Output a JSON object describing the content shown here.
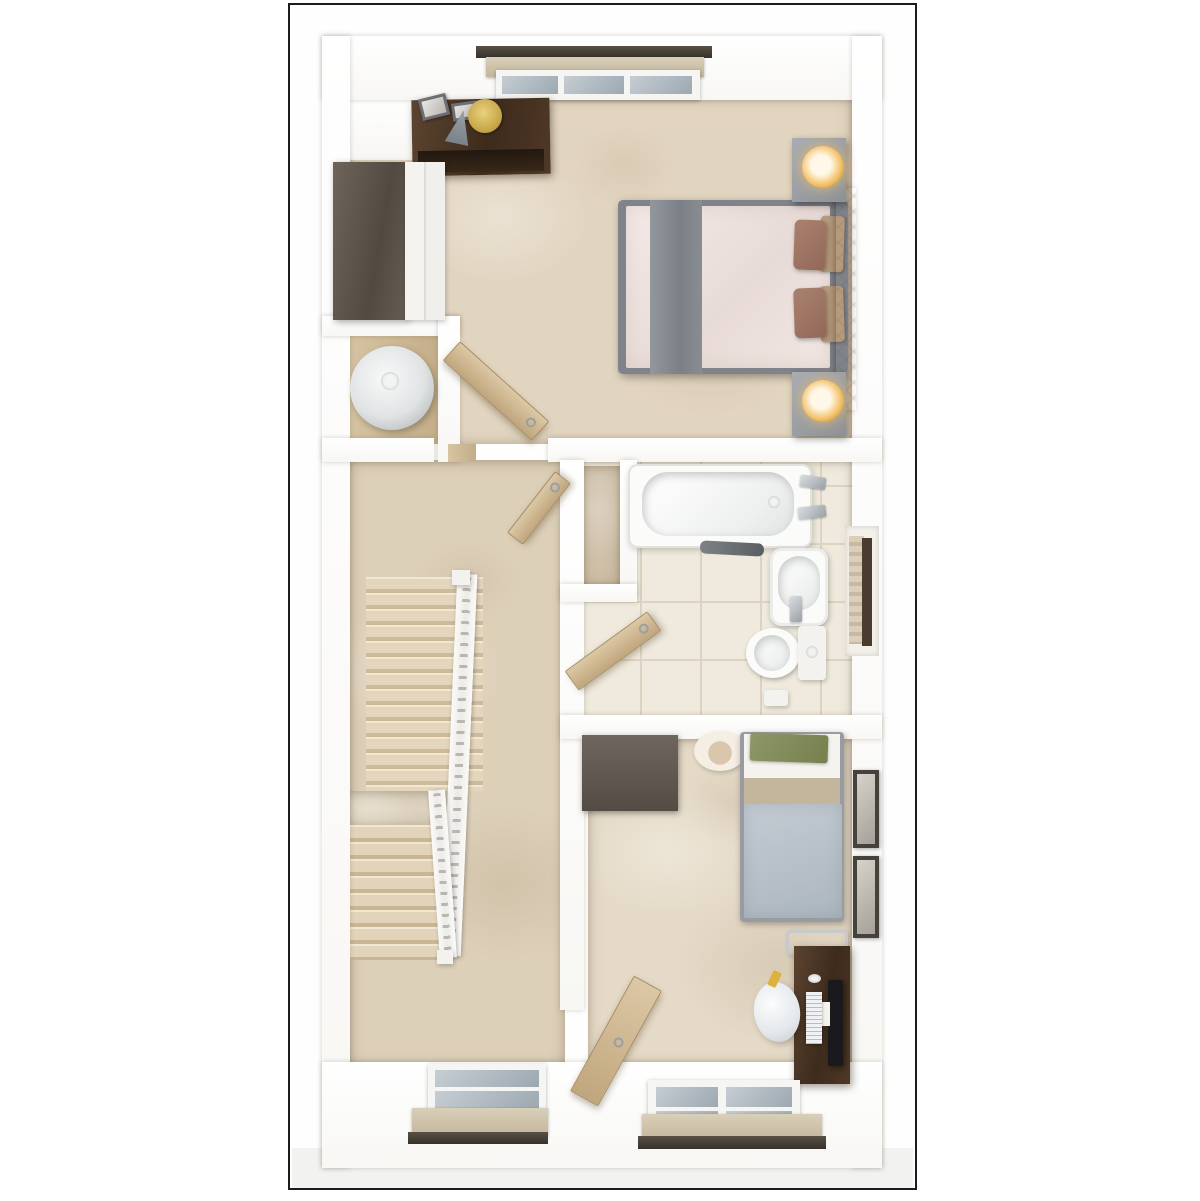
{
  "meta": {
    "kind": "3d-top-down-floor-plan-render",
    "floors_text": "",
    "labels_text": ""
  },
  "palette": {
    "frame_border": "#1c1c1c",
    "wall": "#ffffff",
    "carpet_master": "#e2d5c0",
    "carpet_landing": "#ddd0b9",
    "carpet_bedroom2": "#e5dac7",
    "carpet_niche": "#d5c6ae",
    "tile_bathroom": "#efeadd",
    "wood_door": "#cdb58c",
    "dark_wood": "#46331f",
    "grey_wood": "#5f564d",
    "bed_grey": "#7f838a",
    "duvet_pink": "#f0e4e1",
    "duvet_blue_grey": "#b8c2cc",
    "lamp_amber": "#f3c066",
    "green_pillow": "#8a9460"
  },
  "scene": {
    "elements": [
      {
        "name": "plan-frame",
        "cls": "frame",
        "x": 288,
        "y": 3,
        "w": 629,
        "h": 1187
      },
      {
        "name": "ground-shadow-strip",
        "cls": "ground",
        "x": 292,
        "y": 1148,
        "w": 621,
        "h": 40
      },
      {
        "name": "master-bedroom-floor",
        "cls": "carpet",
        "x": 347,
        "y": 96,
        "w": 505,
        "h": 348,
        "bgc": "#e2d5c0"
      },
      {
        "name": "airing-cupboard-floor",
        "cls": "woodfloor",
        "x": 344,
        "y": 332,
        "w": 100,
        "h": 112
      },
      {
        "name": "landing-floor",
        "cls": "carpet",
        "x": 350,
        "y": 460,
        "w": 215,
        "h": 605,
        "bgc": "#ddd0b9"
      },
      {
        "name": "bathroom-floor",
        "cls": "tile",
        "x": 582,
        "y": 460,
        "w": 270,
        "h": 257
      },
      {
        "name": "stair-niche-floor",
        "cls": "carpet",
        "x": 582,
        "y": 466,
        "w": 38,
        "h": 120,
        "bgc": "#d5c6ae"
      },
      {
        "name": "bedroom2-floor",
        "cls": "carpet",
        "x": 588,
        "y": 737,
        "w": 264,
        "h": 328,
        "bgc": "#e5dac7"
      },
      {
        "name": "wall-face-top-left",
        "cls": "wallface",
        "x": 347,
        "y": 96,
        "w": 78,
        "h": 64
      },
      {
        "name": "stairs-upper-flight",
        "cls": "flight",
        "x": 366,
        "y": 577,
        "w": 117,
        "h": 214
      },
      {
        "name": "stairs-mid-landing",
        "cls": "carpet",
        "x": 350,
        "y": 791,
        "w": 96,
        "h": 34,
        "bgc": "#e7dcc7"
      },
      {
        "name": "stairs-lower-flight",
        "cls": "flight2",
        "x": 350,
        "y": 825,
        "w": 95,
        "h": 135
      },
      {
        "name": "stair-railing-outer",
        "cls": "railing",
        "x": 449,
        "y": 574,
        "w": 20,
        "h": 382,
        "rot": 2.5
      },
      {
        "name": "stair-railing-inner",
        "cls": "railing",
        "x": 434,
        "y": 790,
        "w": 17,
        "h": 168,
        "rot": -4
      },
      {
        "name": "stair-newel-top",
        "cls": "white-furn",
        "x": 452,
        "y": 570,
        "w": 18,
        "h": 15
      },
      {
        "name": "stair-newel-bottom",
        "cls": "white-furn",
        "x": 437,
        "y": 950,
        "w": 16,
        "h": 14
      },
      {
        "name": "wall-top",
        "cls": "wall",
        "x": 322,
        "y": 36,
        "w": 560,
        "h": 64
      },
      {
        "name": "wall-left",
        "cls": "wall",
        "x": 322,
        "y": 36,
        "w": 28,
        "h": 1132
      },
      {
        "name": "wall-right",
        "cls": "wall",
        "x": 852,
        "y": 36,
        "w": 30,
        "h": 1132
      },
      {
        "name": "wall-bottom",
        "cls": "wall",
        "x": 322,
        "y": 1062,
        "w": 560,
        "h": 106
      },
      {
        "name": "wall-bedroom-landing-left",
        "cls": "wall",
        "x": 322,
        "y": 438,
        "w": 112,
        "h": 24
      },
      {
        "name": "wall-bedroom-landing-right",
        "cls": "wall",
        "x": 548,
        "y": 438,
        "w": 334,
        "h": 24
      },
      {
        "name": "wall-cupboard-top",
        "cls": "wall",
        "x": 322,
        "y": 316,
        "w": 138,
        "h": 20
      },
      {
        "name": "wall-cupboard-right",
        "cls": "wall",
        "x": 438,
        "y": 316,
        "w": 22,
        "h": 146
      },
      {
        "name": "wall-landing-bathroom",
        "cls": "wall",
        "x": 560,
        "y": 460,
        "w": 24,
        "h": 550
      },
      {
        "name": "wall-niche-right",
        "cls": "wall",
        "x": 620,
        "y": 460,
        "w": 17,
        "h": 138
      },
      {
        "name": "wall-niche-bottom",
        "cls": "wall",
        "x": 560,
        "y": 584,
        "w": 77,
        "h": 18
      },
      {
        "name": "wall-bathroom-bedroom2",
        "cls": "wall",
        "x": 560,
        "y": 715,
        "w": 322,
        "h": 24
      },
      {
        "name": "window-top-curtain-rail",
        "cls": "railbar",
        "x": 476,
        "y": 46,
        "w": 236,
        "h": 12
      },
      {
        "name": "window-top-blind",
        "cls": "blind",
        "x": 486,
        "y": 57,
        "w": 218,
        "h": 20
      },
      {
        "name": "window-top-frame",
        "cls": "winframe",
        "x": 496,
        "y": 70,
        "w": 204,
        "h": 30
      },
      {
        "name": "window-top-pane-1",
        "cls": "glass",
        "x": 502,
        "y": 76,
        "w": 56,
        "h": 18
      },
      {
        "name": "window-top-pane-2",
        "cls": "glass",
        "x": 564,
        "y": 76,
        "w": 60,
        "h": 18
      },
      {
        "name": "window-top-pane-3",
        "cls": "glass",
        "x": 630,
        "y": 76,
        "w": 62,
        "h": 18
      },
      {
        "name": "dresser",
        "cls": "darkwood",
        "x": 412,
        "y": 99,
        "w": 138,
        "h": 76,
        "rot": -1
      },
      {
        "name": "dresser-drawer-front",
        "cls": "drawers",
        "x": 418,
        "y": 150,
        "w": 126,
        "h": 22,
        "rot": -1
      },
      {
        "name": "dresser-photo-frame-1",
        "cls": "greyframe",
        "x": 420,
        "y": 96,
        "w": 28,
        "h": 22,
        "rot": -14
      },
      {
        "name": "dresser-photo-frame-2",
        "cls": "greyframe",
        "x": 452,
        "y": 102,
        "w": 26,
        "h": 18,
        "rot": -8
      },
      {
        "name": "dresser-gold-tray",
        "cls": "goldtray",
        "x": 468,
        "y": 99,
        "w": 34,
        "h": 34
      },
      {
        "name": "dresser-lamp-shade",
        "cls": "cone",
        "x": 448,
        "y": 110,
        "w": 24,
        "h": 34,
        "rot": 12
      },
      {
        "name": "wardrobe-top-panel",
        "cls": "greywood",
        "x": 333,
        "y": 162,
        "w": 74,
        "h": 158
      },
      {
        "name": "wardrobe-doors",
        "cls": "wdoors",
        "x": 405,
        "y": 162,
        "w": 40,
        "h": 158
      },
      {
        "name": "double-bed-frame",
        "cls": "bedframe",
        "x": 618,
        "y": 200,
        "w": 230,
        "h": 174
      },
      {
        "name": "double-bed-duvet",
        "cls": "duvet",
        "x": 626,
        "y": 206,
        "w": 204,
        "h": 162
      },
      {
        "name": "double-bed-runner",
        "cls": "runner",
        "x": 650,
        "y": 200,
        "w": 52,
        "h": 174
      },
      {
        "name": "double-bed-cushion-1",
        "cls": "cushion-tan",
        "x": 820,
        "y": 216,
        "w": 24,
        "h": 56,
        "rot": 2
      },
      {
        "name": "double-bed-cushion-2",
        "cls": "cushion-tan",
        "x": 820,
        "y": 286,
        "w": 24,
        "h": 56,
        "rot": -2
      },
      {
        "name": "double-bed-pillow-1",
        "cls": "pillow",
        "x": 794,
        "y": 220,
        "w": 32,
        "h": 50,
        "rot": 2
      },
      {
        "name": "double-bed-pillow-2",
        "cls": "pillow",
        "x": 794,
        "y": 288,
        "w": 32,
        "h": 50,
        "rot": -2
      },
      {
        "name": "double-bed-headboard",
        "cls": "headboard",
        "x": 836,
        "y": 188,
        "w": 20,
        "h": 222
      },
      {
        "name": "nightstand-north",
        "cls": "nightstand",
        "x": 792,
        "y": 138,
        "w": 54,
        "h": 64
      },
      {
        "name": "nightstand-north-lamp",
        "cls": "lamp",
        "x": 802,
        "y": 146,
        "w": 42,
        "h": 42
      },
      {
        "name": "nightstand-south",
        "cls": "nightstand",
        "x": 792,
        "y": 372,
        "w": 54,
        "h": 64
      },
      {
        "name": "nightstand-south-lamp",
        "cls": "lamp",
        "x": 802,
        "y": 380,
        "w": 42,
        "h": 42
      },
      {
        "name": "water-cylinder",
        "cls": "cylinder",
        "x": 350,
        "y": 346,
        "w": 84,
        "h": 84
      },
      {
        "name": "water-cylinder-cap",
        "cls": "cap",
        "x": 381,
        "y": 372,
        "w": 18,
        "h": 18
      },
      {
        "name": "door-threshold-master",
        "cls": "woodfloor",
        "x": 448,
        "y": 444,
        "w": 28,
        "h": 18
      },
      {
        "name": "door-master-bedroom",
        "cls": "door",
        "x": 436,
        "y": 378,
        "w": 120,
        "h": 26,
        "rot": 42
      },
      {
        "name": "door-landing-cupboard",
        "cls": "door",
        "x": 500,
        "y": 498,
        "w": 78,
        "h": 20,
        "rot": -52
      },
      {
        "name": "door-bathroom",
        "cls": "door",
        "x": 562,
        "y": 639,
        "w": 102,
        "h": 24,
        "rot": -36
      },
      {
        "name": "door-bedroom2",
        "cls": "door",
        "x": 600,
        "y": 975,
        "w": 32,
        "h": 132,
        "rot": 29
      },
      {
        "name": "bathtub",
        "cls": "tub",
        "x": 628,
        "y": 464,
        "w": 184,
        "h": 84
      },
      {
        "name": "bathtub-basin",
        "cls": "tubinner",
        "x": 642,
        "y": 472,
        "w": 152,
        "h": 64
      },
      {
        "name": "bathtub-drain",
        "cls": "cap",
        "x": 768,
        "y": 496,
        "w": 12,
        "h": 12
      },
      {
        "name": "bathtub-tap-1",
        "cls": "chrome",
        "x": 800,
        "y": 476,
        "w": 26,
        "h": 12,
        "rot": 8
      },
      {
        "name": "bathtub-tap-2",
        "cls": "chrome",
        "x": 798,
        "y": 506,
        "w": 28,
        "h": 12,
        "rot": -6
      },
      {
        "name": "bath-shelf",
        "cls": "darkshelf",
        "x": 700,
        "y": 542,
        "w": 64,
        "h": 13,
        "rot": 3
      },
      {
        "name": "towel-radiator-recess",
        "cls": "recess",
        "x": 845,
        "y": 526,
        "w": 34,
        "h": 130
      },
      {
        "name": "towel-radiator",
        "cls": "ladder",
        "x": 849,
        "y": 536,
        "w": 15,
        "h": 108
      },
      {
        "name": "towel-radiator-edge",
        "cls": "darkbar",
        "x": 862,
        "y": 538,
        "w": 10,
        "h": 108
      },
      {
        "name": "sink",
        "cls": "sink",
        "x": 770,
        "y": 548,
        "w": 58,
        "h": 78
      },
      {
        "name": "sink-basin",
        "cls": "tubinner",
        "x": 778,
        "y": 556,
        "w": 42,
        "h": 54
      },
      {
        "name": "sink-tap",
        "cls": "chrome",
        "x": 790,
        "y": 596,
        "w": 12,
        "h": 26
      },
      {
        "name": "toilet-bowl",
        "cls": "toiletbowl",
        "x": 746,
        "y": 628,
        "w": 54,
        "h": 50
      },
      {
        "name": "toilet-seat",
        "cls": "tubinner",
        "x": 754,
        "y": 635,
        "w": 36,
        "h": 36,
        "rad": "50%"
      },
      {
        "name": "toilet-cistern",
        "cls": "white-furn",
        "x": 798,
        "y": 626,
        "w": 28,
        "h": 54,
        "rad": "4px"
      },
      {
        "name": "toilet-flush",
        "cls": "cap",
        "x": 806,
        "y": 646,
        "w": 12,
        "h": 12
      },
      {
        "name": "toilet-paper-roll",
        "cls": "white-furn",
        "x": 764,
        "y": 690,
        "w": 24,
        "h": 16,
        "rad": "3px"
      },
      {
        "name": "bedroom2-wardrobe",
        "cls": "greywood2",
        "x": 582,
        "y": 735,
        "w": 96,
        "h": 76
      },
      {
        "name": "straw-hat",
        "cls": "hat",
        "x": 694,
        "y": 731,
        "w": 52,
        "h": 40
      },
      {
        "name": "single-bed-frame",
        "cls": "bedframe2",
        "x": 740,
        "y": 732,
        "w": 104,
        "h": 190
      },
      {
        "name": "single-bed-sheet",
        "cls": "sheet",
        "x": 744,
        "y": 734,
        "w": 96,
        "h": 46
      },
      {
        "name": "single-bed-green-throw",
        "cls": "greenthrow",
        "x": 750,
        "y": 734,
        "w": 78,
        "h": 28,
        "rot": 2
      },
      {
        "name": "single-bed-tan-band",
        "cls": "tanband",
        "x": 744,
        "y": 778,
        "w": 96,
        "h": 28
      },
      {
        "name": "single-bed-duvet",
        "cls": "duvet2",
        "x": 744,
        "y": 804,
        "w": 98,
        "h": 114
      },
      {
        "name": "wall-photo-frame-1",
        "cls": "photo",
        "x": 853,
        "y": 770,
        "w": 26,
        "h": 78
      },
      {
        "name": "wall-photo-frame-2",
        "cls": "photo",
        "x": 853,
        "y": 856,
        "w": 26,
        "h": 82
      },
      {
        "name": "desk-chair",
        "cls": "chairframe",
        "x": 786,
        "y": 930,
        "w": 62,
        "h": 26
      },
      {
        "name": "desk",
        "cls": "darkwood",
        "x": 794,
        "y": 946,
        "w": 56,
        "h": 138
      },
      {
        "name": "desk-monitor",
        "cls": "monitor",
        "x": 828,
        "y": 980,
        "w": 15,
        "h": 86
      },
      {
        "name": "desk-monitor-stand",
        "cls": "sheet",
        "x": 818,
        "y": 1002,
        "w": 12,
        "h": 24
      },
      {
        "name": "desk-keyboard",
        "cls": "keyboard",
        "x": 806,
        "y": 992,
        "w": 16,
        "h": 52
      },
      {
        "name": "desk-mouse",
        "cls": "cap",
        "x": 808,
        "y": 974,
        "w": 13,
        "h": 9
      },
      {
        "name": "desk-blue-item",
        "cls": "bluedot",
        "x": 795,
        "y": 1010,
        "w": 5,
        "h": 9
      },
      {
        "name": "beanbag",
        "cls": "beanbag",
        "x": 754,
        "y": 982,
        "w": 46,
        "h": 60,
        "rot": -8
      },
      {
        "name": "beanbag-yellow-item",
        "cls": "yellow",
        "x": 770,
        "y": 971,
        "w": 9,
        "h": 16,
        "rot": 25
      },
      {
        "name": "window-bottom-left-frame",
        "cls": "winframe",
        "x": 428,
        "y": 1064,
        "w": 118,
        "h": 52
      },
      {
        "name": "window-bottom-left-pane-1",
        "cls": "glass",
        "x": 435,
        "y": 1070,
        "w": 104,
        "h": 17
      },
      {
        "name": "window-bottom-left-pane-2",
        "cls": "glass",
        "x": 435,
        "y": 1091,
        "w": 104,
        "h": 18
      },
      {
        "name": "window-bottom-left-blind",
        "cls": "blind",
        "x": 412,
        "y": 1108,
        "w": 136,
        "h": 28
      },
      {
        "name": "window-bottom-left-rail",
        "cls": "railbar",
        "x": 408,
        "y": 1132,
        "w": 140,
        "h": 12
      },
      {
        "name": "window-bottom-right-frame",
        "cls": "winframe",
        "x": 648,
        "y": 1080,
        "w": 152,
        "h": 58
      },
      {
        "name": "window-bottom-right-pane-1",
        "cls": "glass",
        "x": 656,
        "y": 1087,
        "w": 62,
        "h": 20
      },
      {
        "name": "window-bottom-right-pane-2",
        "cls": "glass",
        "x": 726,
        "y": 1087,
        "w": 66,
        "h": 20
      },
      {
        "name": "window-bottom-right-pane-3",
        "cls": "glass",
        "x": 656,
        "y": 1111,
        "w": 62,
        "h": 20
      },
      {
        "name": "window-bottom-right-pane-4",
        "cls": "glass",
        "x": 726,
        "y": 1111,
        "w": 66,
        "h": 20
      },
      {
        "name": "window-bottom-right-blind",
        "cls": "blind",
        "x": 642,
        "y": 1114,
        "w": 180,
        "h": 28
      },
      {
        "name": "window-bottom-right-rail",
        "cls": "railbar",
        "x": 638,
        "y": 1136,
        "w": 188,
        "h": 13
      }
    ]
  }
}
